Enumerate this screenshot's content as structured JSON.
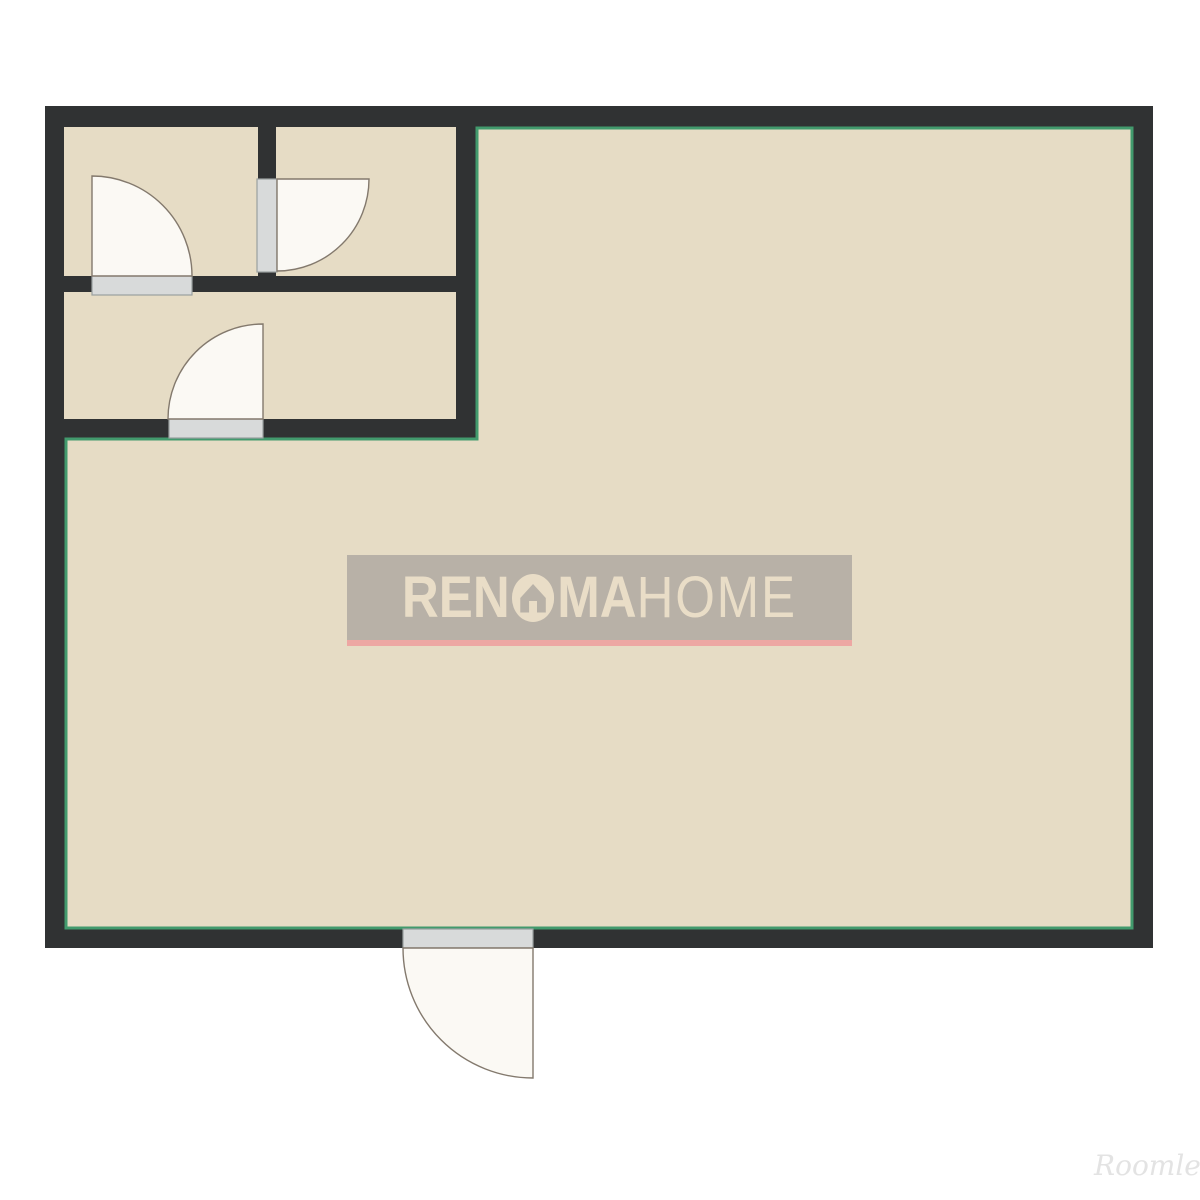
{
  "watermark": {
    "prefix": "REN",
    "mid": "MA",
    "suffix": "HOME",
    "logo_icon": "house-circle-icon"
  },
  "credit": {
    "label": "Roomle"
  },
  "colors": {
    "background": "#ffffff",
    "wall": "#303233",
    "floor": "#e6dcc5",
    "outline": "#429a6d",
    "sill_fill": "#d8dada",
    "sill_stroke": "#9aa0a0",
    "swing_fill": "#fbf9f4",
    "swing_stroke": "#83796d",
    "wm_bg": "#b8b1a7",
    "wm_text": "#e9ddc7",
    "wm_underline": "#eda7a3",
    "credit_text": "#e3e3e3"
  }
}
